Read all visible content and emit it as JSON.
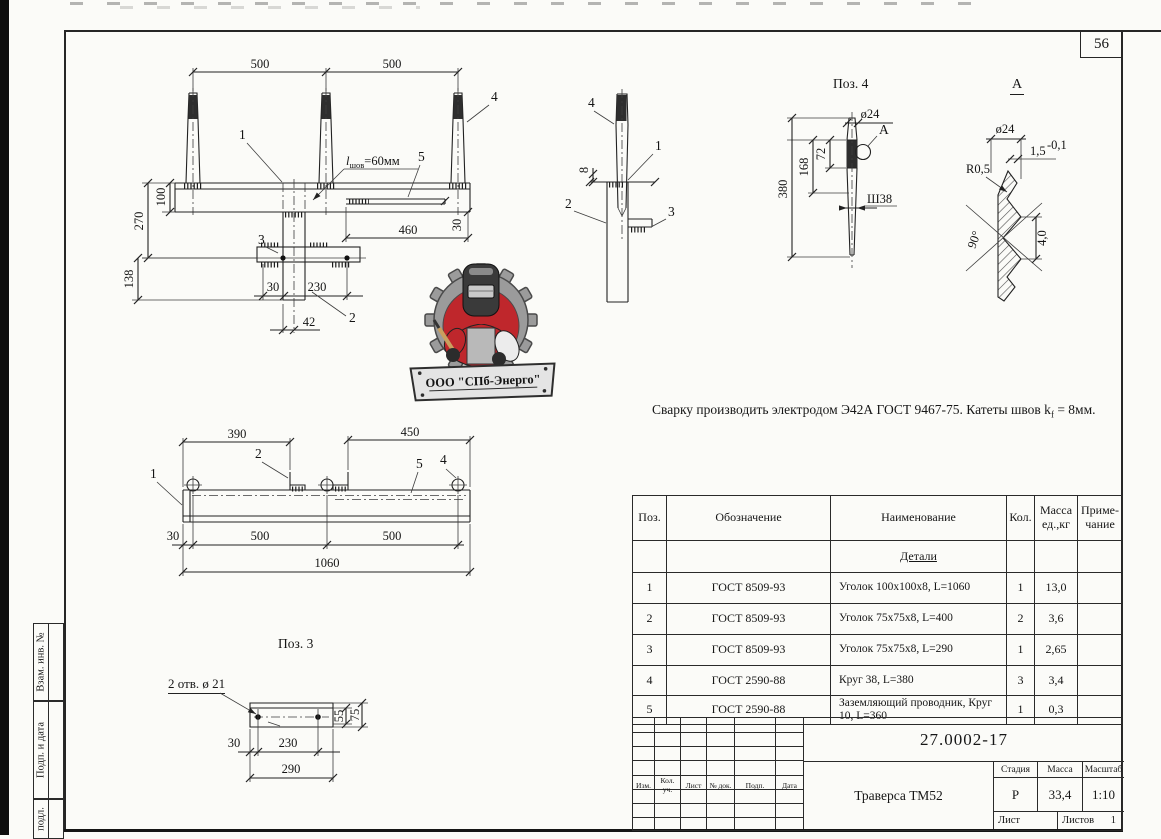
{
  "page": {
    "number": "56"
  },
  "frame": {
    "sidebar_labels": [
      "Взам. инв. №",
      "Подп. и дата",
      "подл."
    ]
  },
  "logo": {
    "company": "ООО \"СПб-Энерго\""
  },
  "note": {
    "main": "Сварку производить электродом Э42А ГОСТ 9467-75.  Катеты швов k",
    "sub": "f",
    "end": " = 8мм."
  },
  "front_view": {
    "dim_500_left": "500",
    "dim_500_right": "500",
    "label_1": "1",
    "label_2": "2",
    "label_3": "3",
    "label_4": "4",
    "label_5": "5",
    "weld_pre": "l",
    "weld_sub": "шов",
    "weld_post": "=60мм",
    "dim_100": "100",
    "dim_270": "270",
    "dim_138": "138",
    "dim_460": "460",
    "dim_30_right": "30",
    "dim_30_bottom": "30",
    "dim_230": "230",
    "dim_42": "42"
  },
  "side_view": {
    "label_1": "1",
    "label_2": "2",
    "label_3": "3",
    "label_4": "4",
    "dim_8": "8"
  },
  "pos4_view": {
    "title": "Поз. 4",
    "dim_dia": "ø24",
    "callout": "А",
    "dim_72": "72",
    "dim_168": "168",
    "dim_380": "380",
    "dim_thread": "Ш38"
  },
  "detail_a": {
    "title": "А",
    "dim_dia": "ø24",
    "dim_crest": "1,5",
    "dim_crest_tol": "-0,1",
    "dim_radius": "R0,5",
    "dim_angle": "90°",
    "dim_depth": "4,0"
  },
  "plan_view": {
    "dim_390": "390",
    "dim_450": "450",
    "label_1": "1",
    "label_2": "2",
    "label_4": "4",
    "label_5": "5",
    "dim_30": "30",
    "dim_500_left": "500",
    "dim_500_right": "500",
    "dim_1060": "1060"
  },
  "pos3_view": {
    "title": "Поз. 3",
    "holes_note": "2 отв. ø 21",
    "dim_30": "30",
    "dim_230": "230",
    "dim_290": "290",
    "dim_55": "55",
    "dim_75": "75"
  },
  "spec_table": {
    "col_pos": "Поз.",
    "col_doc": "Обозначение",
    "col_name": "Наименование",
    "col_qty": "Кол.",
    "col_mass_1": "Масса",
    "col_mass_2": "ед.,кг",
    "col_note_1": "Приме-",
    "col_note_2": "чание",
    "section": "Детали",
    "rows": [
      {
        "pos": "1",
        "doc": "ГОСТ 8509-93",
        "name": "Уголок 100х100х8, L=1060",
        "qty": "1",
        "mass": "13,0",
        "note": ""
      },
      {
        "pos": "2",
        "doc": "ГОСТ 8509-93",
        "name": "Уголок 75х75х8,  L=400",
        "qty": "2",
        "mass": "3,6",
        "note": ""
      },
      {
        "pos": "3",
        "doc": "ГОСТ 8509-93",
        "name": "Уголок 75х75х8,  L=290",
        "qty": "1",
        "mass": "2,65",
        "note": ""
      },
      {
        "pos": "4",
        "doc": "ГОСТ 2590-88",
        "name": "Круг 38, L=380",
        "qty": "3",
        "mass": "3,4",
        "note": ""
      },
      {
        "pos": "5",
        "doc": "ГОСТ 2590-88",
        "name": "Заземляющий проводник, Круг 10, L=360",
        "qty": "1",
        "mass": "0,3",
        "note": ""
      }
    ]
  },
  "title_block": {
    "doc_number": "27.0002-17",
    "product_title": "Траверса ТМ52",
    "col_izm": "Изм.",
    "col_kol": "Кол. уч.",
    "col_list": "Лист",
    "col_doc": "№ док.",
    "col_podp": "Подп.",
    "col_data": "Дата",
    "stage_label": "Стадия",
    "mass_label": "Масса",
    "scale_label": "Масштаб",
    "stage_value": "Р",
    "mass_value": "33,4",
    "scale_value": "1:10",
    "sheet_label": "Лист",
    "sheets_label": "Листов",
    "sheets_value": "1"
  },
  "colors": {
    "logo_red": "#bf272c",
    "logo_gray": "#9b9b9b",
    "line": "#222222",
    "paper": "#fbfbf8"
  }
}
